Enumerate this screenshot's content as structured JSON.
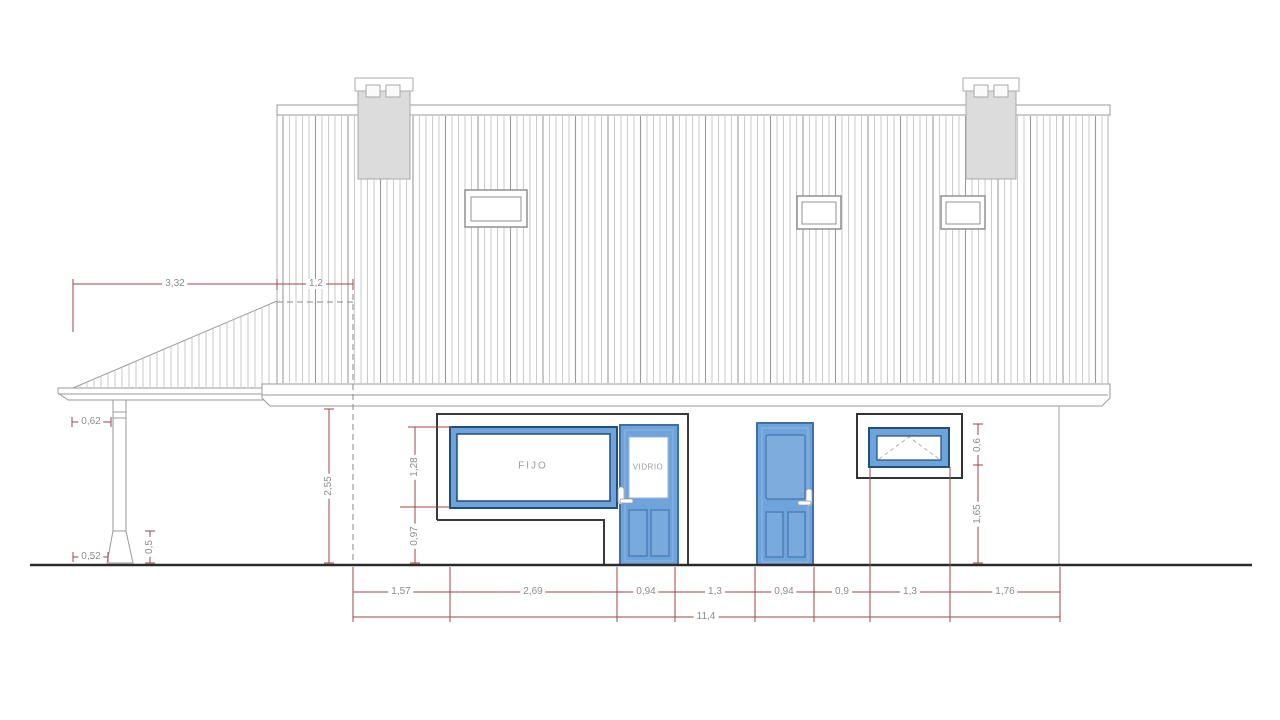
{
  "drawing": {
    "title": "house-front-elevation",
    "window_label": "FIJO",
    "door_label": "VIDRIO",
    "dims": {
      "leanto_width": "3,32",
      "roof_offset": "1,2",
      "eave_to_post": "0,62",
      "post_base_offset": "0,52",
      "post_base_height": "0,5",
      "wall_height": "2,55",
      "window_height": "1,28",
      "window_sill": "0,97",
      "awning_height": "0,6",
      "awning_sill": "1,65",
      "bottom": [
        "1,57",
        "2,69",
        "0,94",
        "1,3",
        "0,94",
        "0,9",
        "1,3",
        "1,76"
      ],
      "total": "11,4"
    },
    "colors": {
      "door_blue": "#6FA3DB",
      "frame_navy": "#1F4E79",
      "dimension_red": "#9E4449",
      "chimney_gray": "#DCDCDC",
      "line_gray": "#9A9A9A"
    }
  }
}
